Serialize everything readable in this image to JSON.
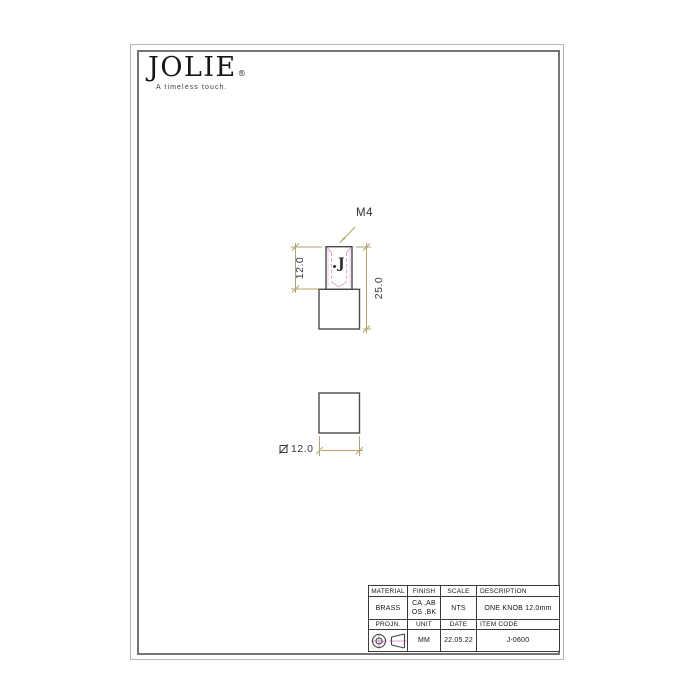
{
  "logo": {
    "brand": "JOLIE",
    "registered": "®",
    "tagline": "A timeless touch."
  },
  "drawing": {
    "thread_label": "M4",
    "neck_height_dim": "12.0",
    "total_height_dim": "25.0",
    "base_square_dim": "12.0",
    "engraving_mark": "J"
  },
  "title_block": {
    "row1_headers": [
      "MATERIAL",
      "FINISH",
      "SCALE",
      "DESCRIPTION"
    ],
    "row1_values": {
      "material": "BRASS",
      "finish_line1": "CA ,AB",
      "finish_line2": "OS ,BK",
      "scale": "NTS",
      "description": "ONE KNOB 12.0mm"
    },
    "row2_headers": [
      "PROJN.",
      "UNIT",
      "DATE",
      "ITEM CODE"
    ],
    "row2_values": {
      "unit": "MM",
      "date": "22.05.22",
      "item_code": "J-0600"
    },
    "projection_icon": "third-angle-projection-symbol"
  },
  "colors": {
    "dimension_line": "#b3a369",
    "hidden_line": "#dca6dc",
    "outline": "#4a4a4a",
    "table_border": "#3a3a3a"
  }
}
